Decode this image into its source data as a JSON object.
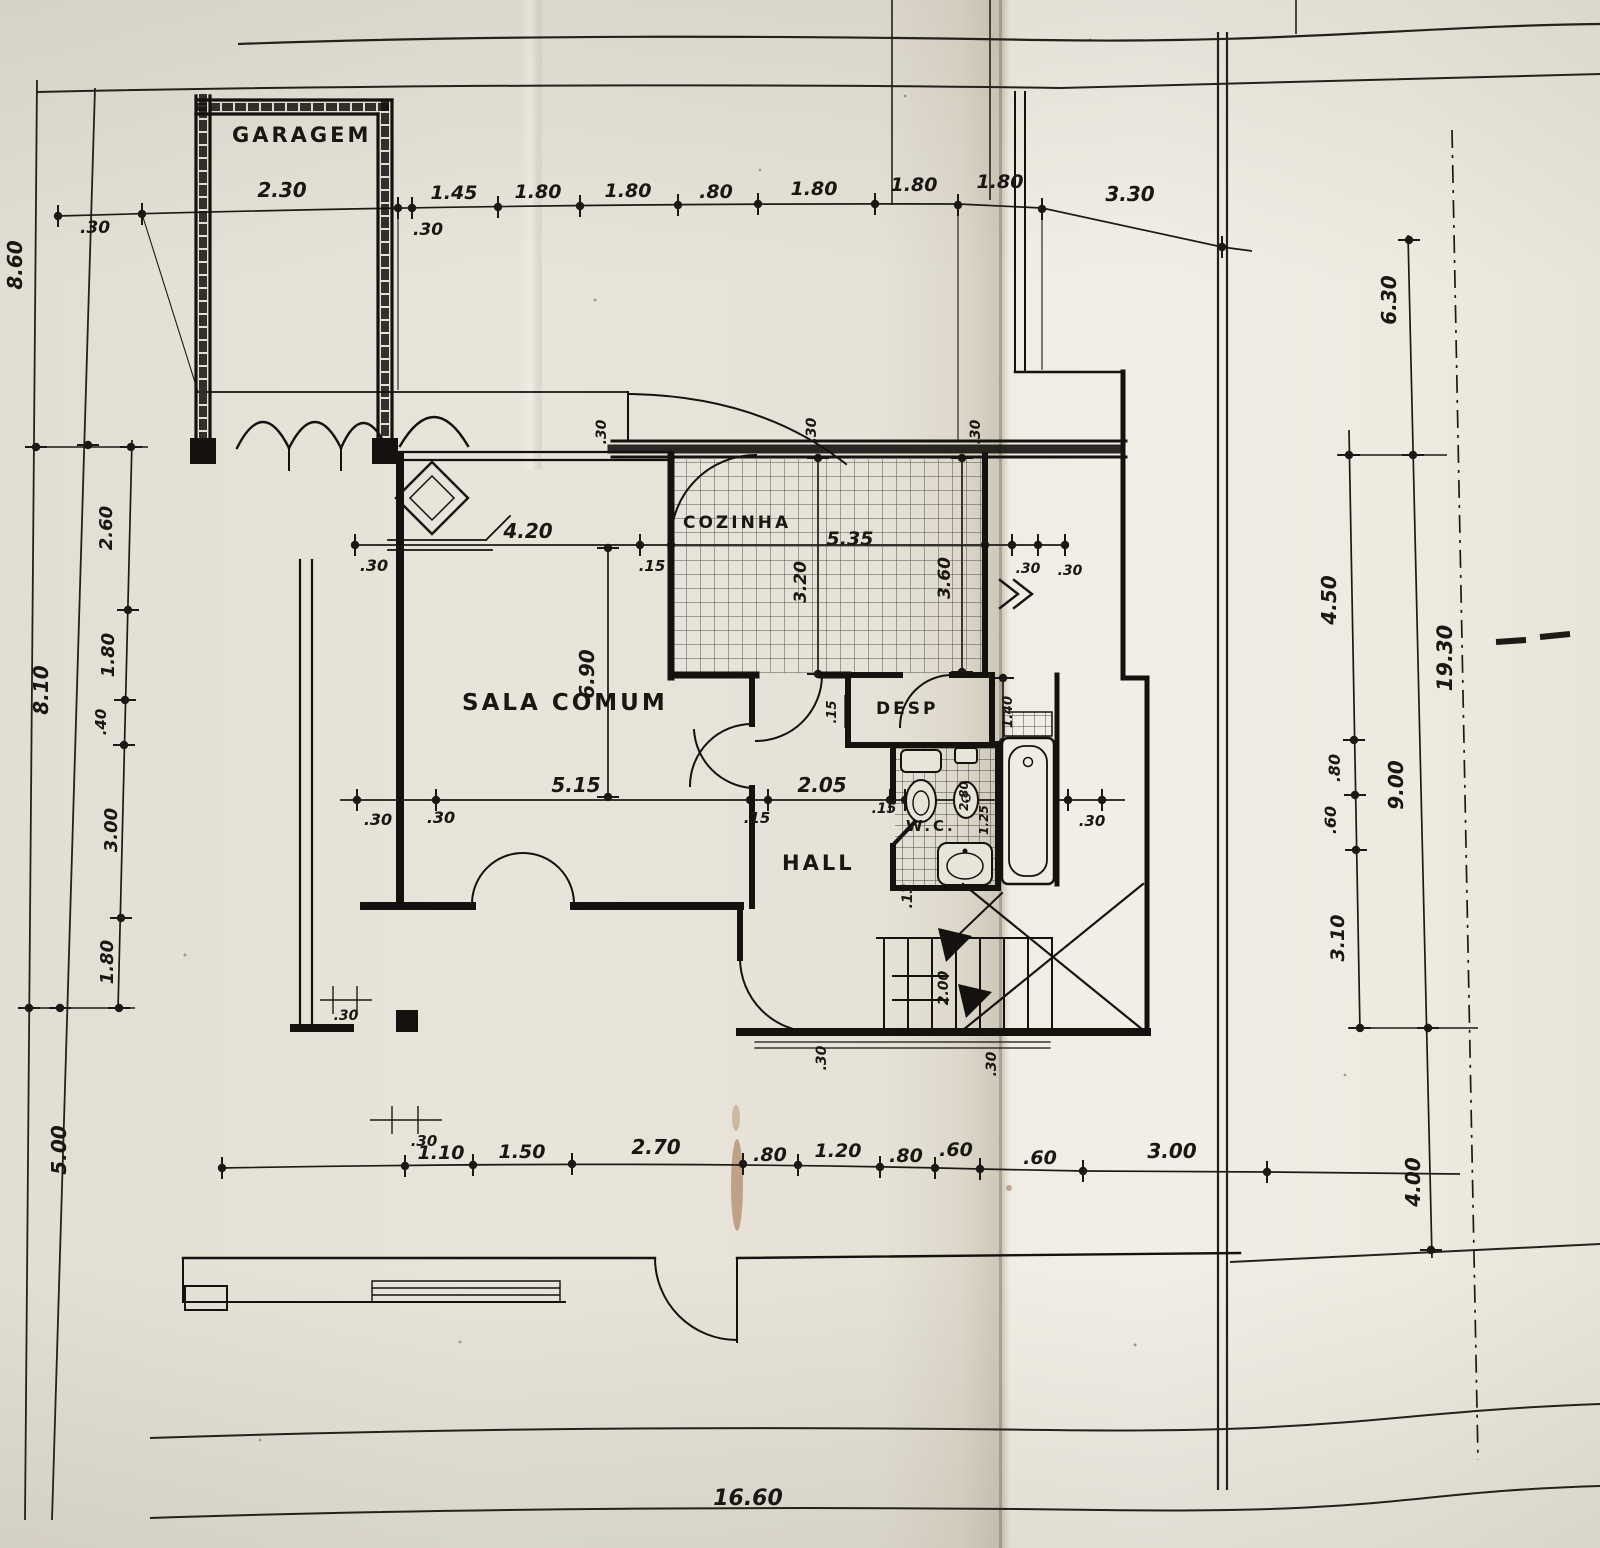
{
  "rooms": {
    "garagem": "GARAGEM",
    "sala_comum": "SALA COMUM",
    "cozinha": "COZINHA",
    "desp": "DESP",
    "wc": "W.C.",
    "hall": "HALL"
  },
  "dims": {
    "top": [
      ".30",
      "2.30",
      ".30",
      "1.45",
      "1.80",
      "1.80",
      ".80",
      "1.80",
      "1.80",
      "1.80",
      "3.30"
    ],
    "bottom": [
      ".30",
      "1.10",
      "1.50",
      "2.70",
      ".80",
      "1.20",
      ".80",
      ".60",
      ".60",
      "3.00"
    ],
    "bottom_total": "16.60",
    "left": {
      "outer": "8.60",
      "outer2": "8.10",
      "s1": "2.60",
      "s2": "1.80",
      "s3": ".40",
      "s4": "3.00",
      "s5": "1.80",
      "bottom": "5.00"
    },
    "right": {
      "r1": "6.30",
      "r2": "4.50",
      "total": "19.30",
      "r3": ".80",
      "r4": ".60",
      "r5": "9.00",
      "r6": "3.10",
      "r7": "4.00"
    },
    "interior": {
      "sala_width": "4.20",
      "sala_wall_left": ".30",
      "sala_wall_right": ".15",
      "sala_depth": "6.90",
      "cozinha_width": "5.35",
      "cozinha_depth_left": "3.20",
      "cozinha_depth_right": "3.60",
      "top_wall_tick_1": ".30",
      "top_wall_tick_2": ".30",
      "top_wall_tick_3": ".30",
      "cozinha_right_tick_1": ".30",
      "cozinha_right_tick_2": ".30",
      "sala_lower_width": "5.15",
      "lower_tick_1": ".30",
      "lower_tick_2": ".30",
      "hall_left_tick": ".15",
      "hall_width": "2.05",
      "hall_right_tick": ".15",
      "desp_left_tick": ".15",
      "desp_depth": "1.40",
      "wc_depth": "2.80",
      "wc_width": "1.25",
      "tub_right_tick": ".30",
      "stair_tick": ".13",
      "stair_width": "2.00",
      "bottom_tick_left": ".30",
      "bottom_tick_right": ".30",
      "sala_corner_tick": ".30"
    }
  }
}
